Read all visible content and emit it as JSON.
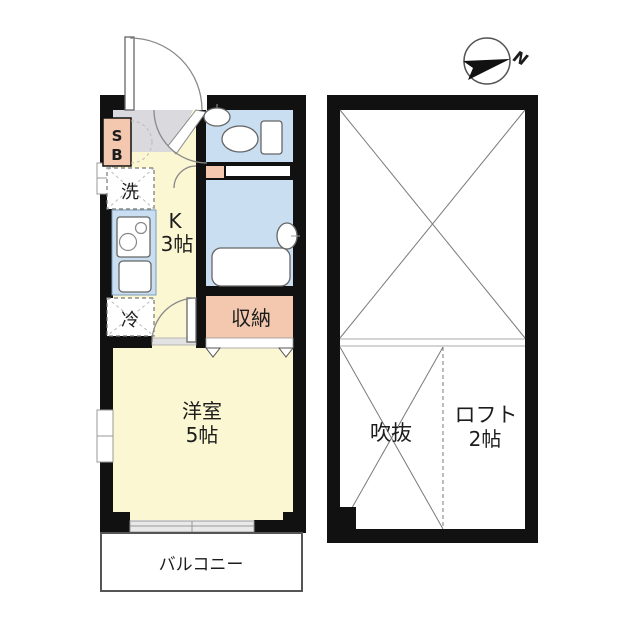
{
  "title": "apartment-floor-plan",
  "compass": {
    "north_label": "N"
  },
  "left_unit": {
    "shoe_box": {
      "line1": "S",
      "line2": "B"
    },
    "washer_label": "洗",
    "kitchen": {
      "line1": "K",
      "line2": "3帖"
    },
    "fridge_label": "冷",
    "storage_label": "収納",
    "western_room": {
      "line1": "洋室",
      "line2": "5帖"
    },
    "balcony_label": "バルコニー"
  },
  "right_unit": {
    "void_label": "吹抜",
    "loft": {
      "line1": "ロフト",
      "line2": "2帖"
    }
  },
  "colors": {
    "wall": "#111111",
    "floor_yellow": "#FBF7D3",
    "wet_area_blue": "#C9DFF1",
    "closet_salmon": "#F4C8AF",
    "entry_gray": "#D9D9DE"
  }
}
